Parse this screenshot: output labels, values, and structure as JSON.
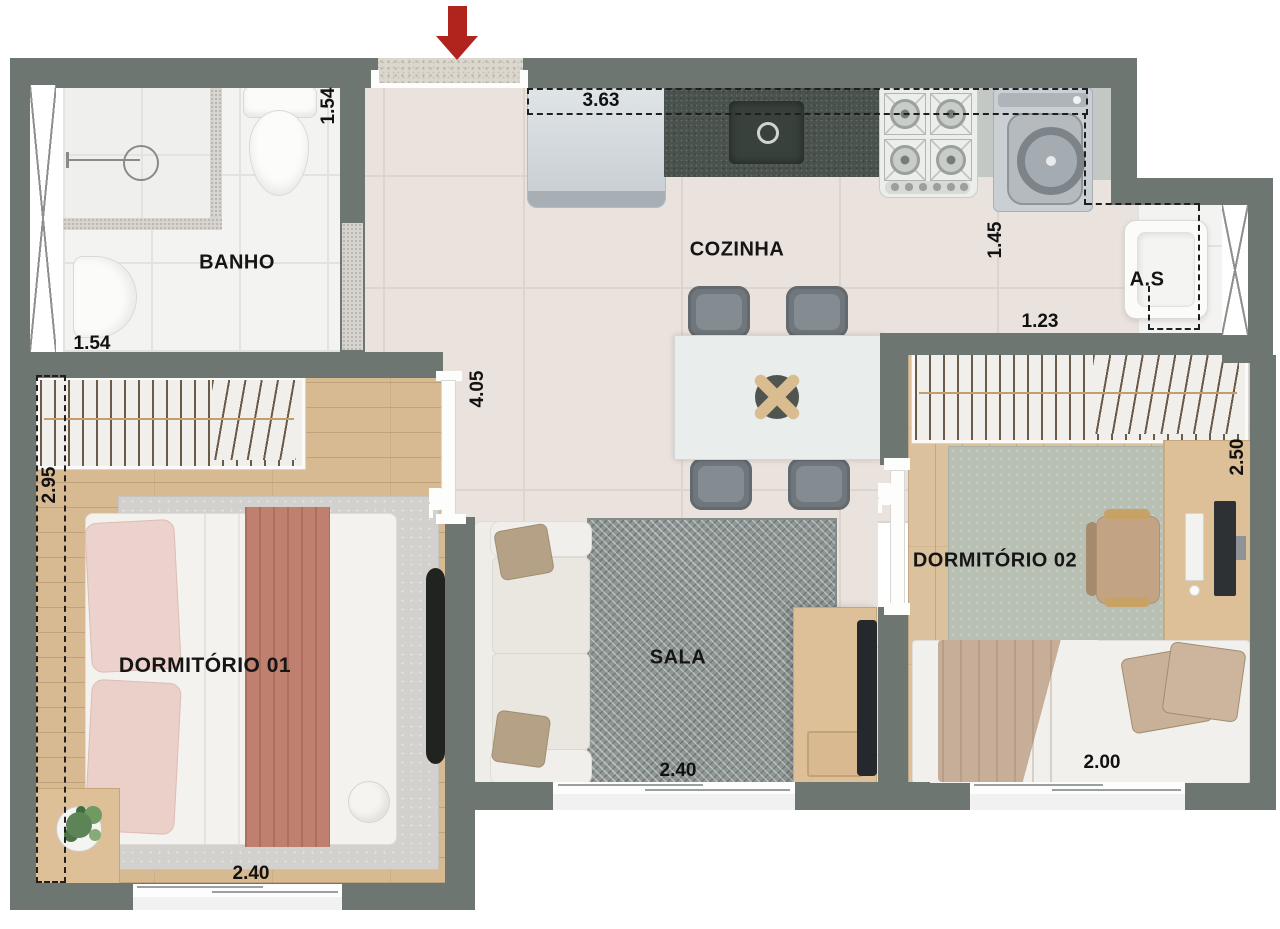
{
  "plan": {
    "type": "apartment-floor-plan",
    "rooms": {
      "banho": {
        "label": "BANHO",
        "dim_side": "1.54",
        "dim_bottom": "1.54"
      },
      "cozinha": {
        "label": "COZINHA",
        "dim_counter": "3.63",
        "dim_laundry": "1.45",
        "dim_service": "1.23"
      },
      "area_servico": {
        "label": "A.S"
      },
      "hall": {
        "dim_length": "4.05"
      },
      "dormitorio1": {
        "label": "DORMITÓRIO 01",
        "dim_side": "2.95",
        "dim_bottom": "2.40"
      },
      "sala": {
        "label": "SALA",
        "dim_bottom": "2.40"
      },
      "dormitorio2": {
        "label": "DORMITÓRIO 02",
        "dim_side": "2.50",
        "dim_bottom": "2.00"
      }
    },
    "colors": {
      "wall": "#6e7672",
      "floor_tile": "#eae2dc",
      "white_tile": "#f3f3f2",
      "wood": "#d8ba92",
      "rug_sala": "#8f9795",
      "rug_dorm1": "#d3d1cd",
      "rug_dorm2": "#b8c0b3",
      "granite_counter": "#49524d",
      "entrance_arrow": "#b1241e",
      "dimension_text": "#111111"
    }
  }
}
